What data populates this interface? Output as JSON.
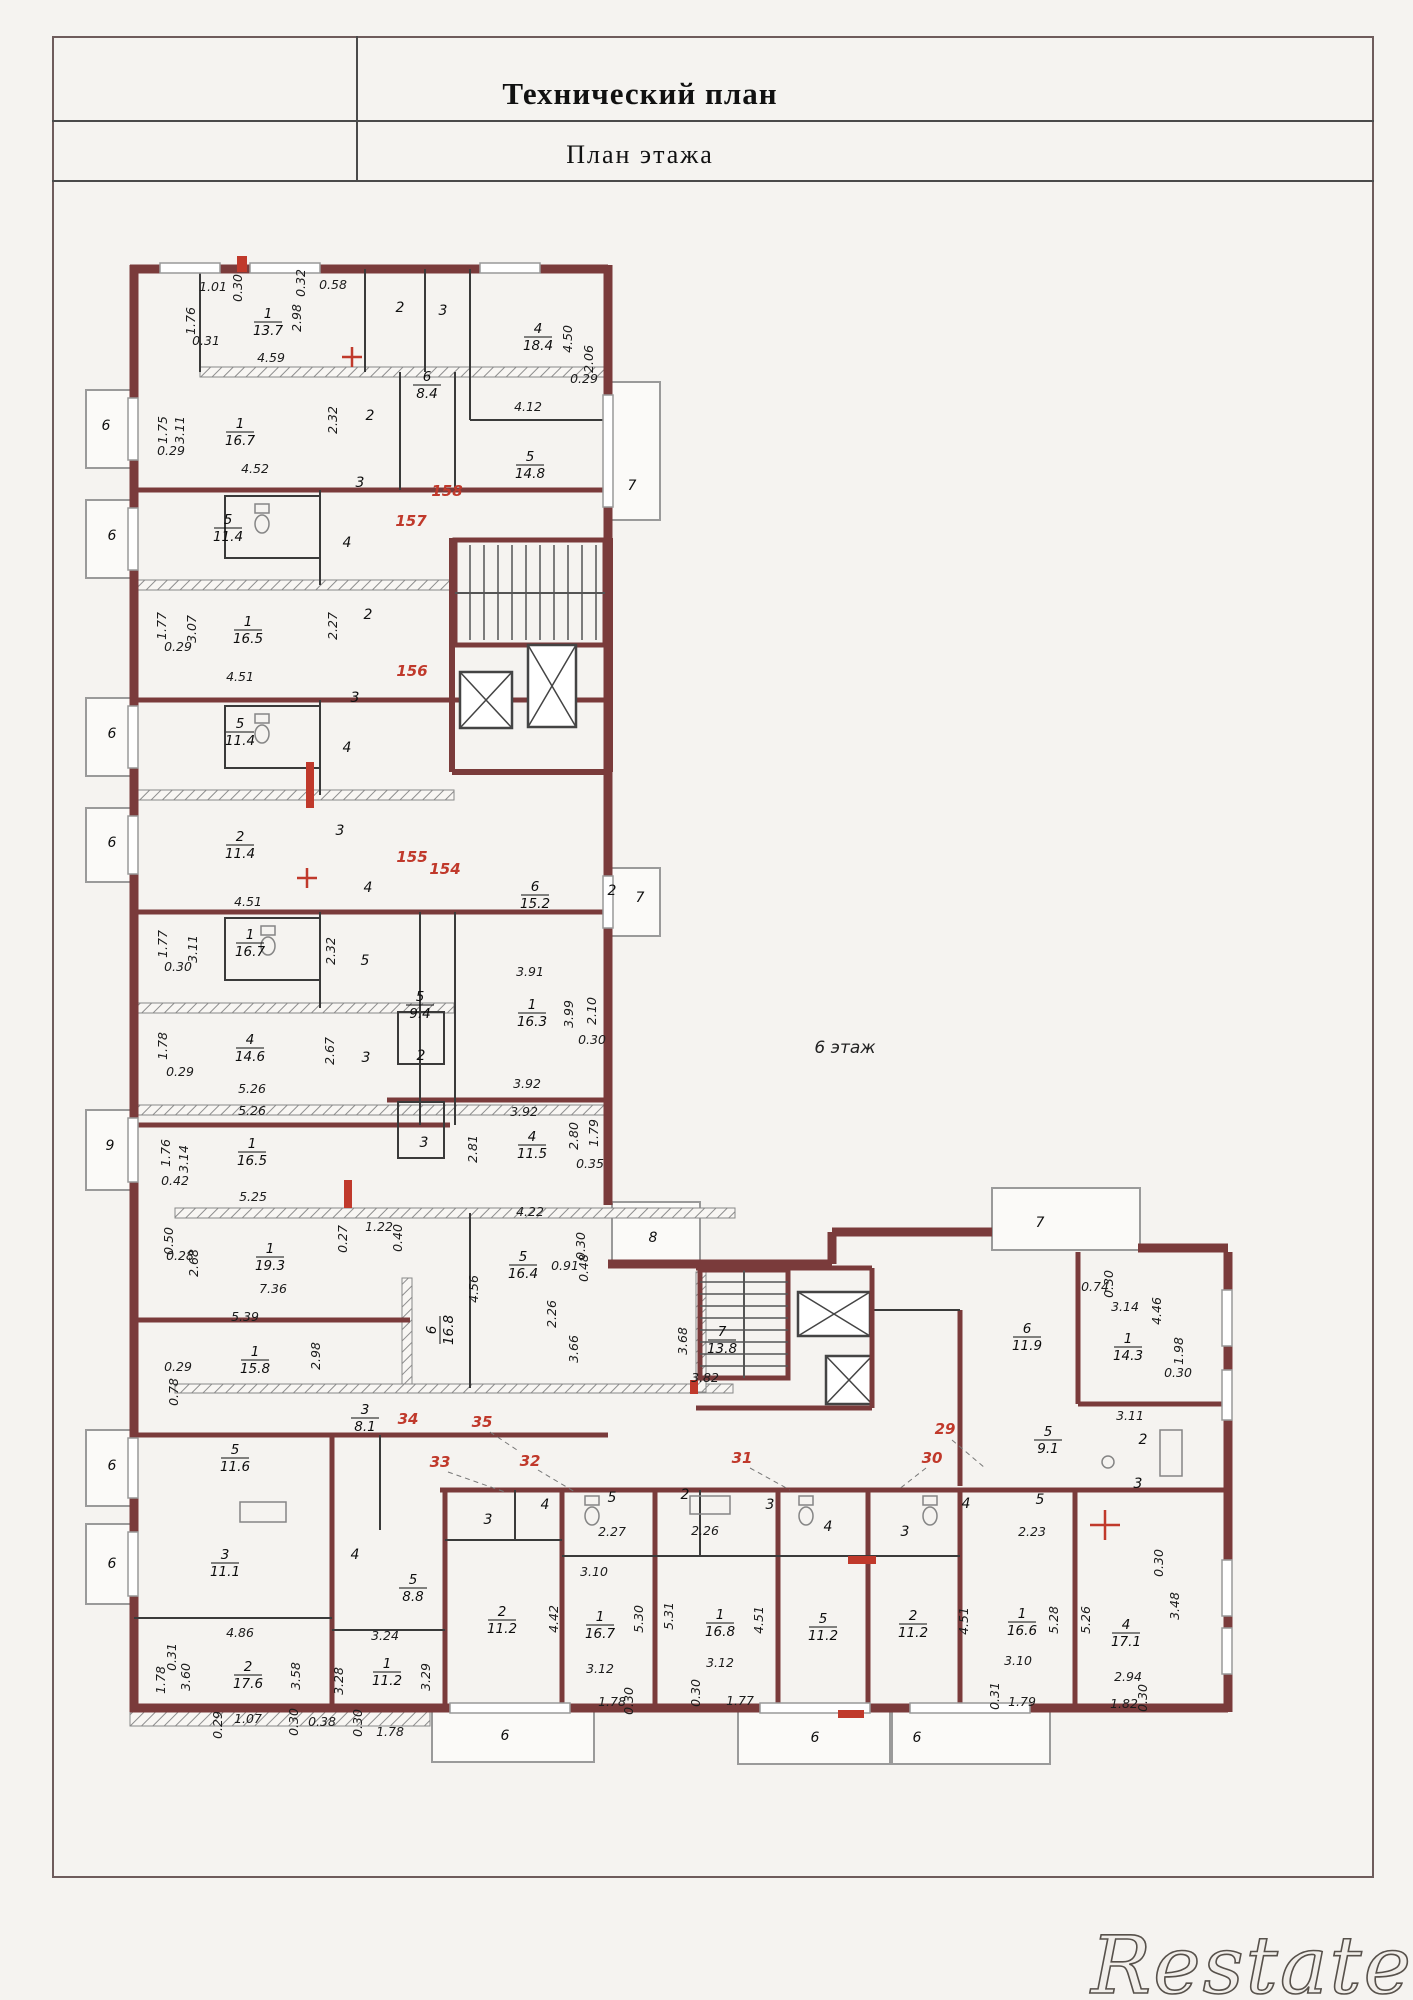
{
  "page": {
    "title": "Технический план",
    "subtitle": "План  этажа",
    "floor_label": "6 этаж",
    "watermark": "Restate"
  },
  "colors": {
    "wall": "#7a3b3b",
    "red_accent": "#c0392b",
    "dim_text": "#1c1c1c",
    "border": "#6e5c5c",
    "paper": "#f5f3f0"
  },
  "plan": {
    "floor_label_pos": {
      "x": 845,
      "y": 1048
    },
    "units": [
      {
        "t": "158",
        "x": 447,
        "y": 496
      },
      {
        "t": "157",
        "x": 411,
        "y": 526
      },
      {
        "t": "156",
        "x": 412,
        "y": 676
      },
      {
        "t": "155",
        "x": 412,
        "y": 862
      },
      {
        "t": "154",
        "x": 445,
        "y": 874
      },
      {
        "t": "35",
        "x": 482,
        "y": 1427
      },
      {
        "t": "34",
        "x": 408,
        "y": 1424
      },
      {
        "t": "33",
        "x": 440,
        "y": 1467
      },
      {
        "t": "32",
        "x": 530,
        "y": 1466
      },
      {
        "t": "31",
        "x": 742,
        "y": 1463
      },
      {
        "t": "30",
        "x": 932,
        "y": 1463
      },
      {
        "t": "29",
        "x": 945,
        "y": 1434
      }
    ],
    "rooms": [
      {
        "n": "1",
        "a": "13.7",
        "x": 268,
        "y": 322
      },
      {
        "n": "1",
        "a": "16.7",
        "x": 240,
        "y": 432
      },
      {
        "n": "4",
        "a": "18.4",
        "x": 538,
        "y": 337
      },
      {
        "n": "6",
        "a": "8.4",
        "x": 427,
        "y": 385
      },
      {
        "n": "5",
        "a": "14.8",
        "x": 530,
        "y": 465
      },
      {
        "n": "5",
        "a": "11.4",
        "x": 228,
        "y": 528
      },
      {
        "n": "1",
        "a": "16.5",
        "x": 248,
        "y": 630
      },
      {
        "n": "5",
        "a": "11.4",
        "x": 240,
        "y": 732
      },
      {
        "n": "2",
        "a": "11.4",
        "x": 240,
        "y": 845
      },
      {
        "n": "1",
        "a": "16.7",
        "x": 250,
        "y": 943
      },
      {
        "n": "5",
        "a": "9.4",
        "x": 420,
        "y": 1005
      },
      {
        "n": "6",
        "a": "15.2",
        "x": 535,
        "y": 895
      },
      {
        "n": "1",
        "a": "16.3",
        "x": 532,
        "y": 1013
      },
      {
        "n": "4",
        "a": "14.6",
        "x": 250,
        "y": 1048
      },
      {
        "n": "4",
        "a": "11.5",
        "x": 532,
        "y": 1145
      },
      {
        "n": "1",
        "a": "16.5",
        "x": 252,
        "y": 1152
      },
      {
        "n": "1",
        "a": "19.3",
        "x": 270,
        "y": 1257
      },
      {
        "n": "1",
        "a": "15.8",
        "x": 255,
        "y": 1360
      },
      {
        "n": "5",
        "a": "16.4",
        "x": 523,
        "y": 1265
      },
      {
        "n": "6",
        "a": "16.8",
        "x": 440,
        "y": 1330,
        "rot": -90
      },
      {
        "n": "7",
        "a": "13.8",
        "x": 722,
        "y": 1340
      },
      {
        "n": "3",
        "a": "8.1",
        "x": 365,
        "y": 1418
      },
      {
        "n": "5",
        "a": "11.6",
        "x": 235,
        "y": 1458
      },
      {
        "n": "6",
        "a": "11.9",
        "x": 1027,
        "y": 1337
      },
      {
        "n": "1",
        "a": "14.3",
        "x": 1128,
        "y": 1347
      },
      {
        "n": "5",
        "a": "9.1",
        "x": 1048,
        "y": 1440
      },
      {
        "n": "3",
        "a": "11.1",
        "x": 225,
        "y": 1563
      },
      {
        "n": "5",
        "a": "8.8",
        "x": 413,
        "y": 1588
      },
      {
        "n": "2",
        "a": "17.6",
        "x": 248,
        "y": 1675
      },
      {
        "n": "1",
        "a": "11.2",
        "x": 387,
        "y": 1672
      },
      {
        "n": "2",
        "a": "11.2",
        "x": 502,
        "y": 1620
      },
      {
        "n": "1",
        "a": "16.7",
        "x": 600,
        "y": 1625
      },
      {
        "n": "1",
        "a": "16.8",
        "x": 720,
        "y": 1623
      },
      {
        "n": "5",
        "a": "11.2",
        "x": 823,
        "y": 1627
      },
      {
        "n": "2",
        "a": "11.2",
        "x": 913,
        "y": 1624
      },
      {
        "n": "1",
        "a": "16.6",
        "x": 1022,
        "y": 1622
      },
      {
        "n": "4",
        "a": "17.1",
        "x": 1126,
        "y": 1633
      }
    ],
    "labels": [
      {
        "t": "2",
        "x": 400,
        "y": 312
      },
      {
        "t": "3",
        "x": 443,
        "y": 315
      },
      {
        "t": "7",
        "x": 632,
        "y": 490
      },
      {
        "t": "6",
        "x": 106,
        "y": 430
      },
      {
        "t": "2",
        "x": 370,
        "y": 420
      },
      {
        "t": "3",
        "x": 360,
        "y": 487
      },
      {
        "t": "6",
        "x": 112,
        "y": 540
      },
      {
        "t": "4",
        "x": 347,
        "y": 547
      },
      {
        "t": "2",
        "x": 368,
        "y": 619
      },
      {
        "t": "3",
        "x": 355,
        "y": 702
      },
      {
        "t": "6",
        "x": 112,
        "y": 738
      },
      {
        "t": "4",
        "x": 347,
        "y": 752
      },
      {
        "t": "3",
        "x": 340,
        "y": 835
      },
      {
        "t": "4",
        "x": 368,
        "y": 892
      },
      {
        "t": "5",
        "x": 365,
        "y": 965
      },
      {
        "t": "6",
        "x": 112,
        "y": 847
      },
      {
        "t": "7",
        "x": 640,
        "y": 902
      },
      {
        "t": "2",
        "x": 612,
        "y": 895
      },
      {
        "t": "2",
        "x": 421,
        "y": 1060
      },
      {
        "t": "3",
        "x": 424,
        "y": 1147
      },
      {
        "t": "3",
        "x": 366,
        "y": 1062
      },
      {
        "t": "9",
        "x": 110,
        "y": 1150
      },
      {
        "t": "8",
        "x": 653,
        "y": 1242
      },
      {
        "t": "7",
        "x": 1040,
        "y": 1227
      },
      {
        "t": "2",
        "x": 1143,
        "y": 1444
      },
      {
        "t": "3",
        "x": 1138,
        "y": 1488
      },
      {
        "t": "5",
        "x": 1040,
        "y": 1504
      },
      {
        "t": "4",
        "x": 966,
        "y": 1508
      },
      {
        "t": "3",
        "x": 770,
        "y": 1509
      },
      {
        "t": "2",
        "x": 685,
        "y": 1499
      },
      {
        "t": "5",
        "x": 612,
        "y": 1502
      },
      {
        "t": "3",
        "x": 488,
        "y": 1524
      },
      {
        "t": "4",
        "x": 545,
        "y": 1509
      },
      {
        "t": "4",
        "x": 828,
        "y": 1531
      },
      {
        "t": "3",
        "x": 905,
        "y": 1536
      },
      {
        "t": "6",
        "x": 112,
        "y": 1470
      },
      {
        "t": "4",
        "x": 355,
        "y": 1559
      },
      {
        "t": "6",
        "x": 112,
        "y": 1568
      },
      {
        "t": "6",
        "x": 505,
        "y": 1740
      },
      {
        "t": "6",
        "x": 815,
        "y": 1742
      },
      {
        "t": "6",
        "x": 917,
        "y": 1742
      }
    ],
    "dims": [
      {
        "t": "1.01",
        "x": 213,
        "y": 291
      },
      {
        "t": "0.30",
        "x": 242,
        "y": 288,
        "r": 1
      },
      {
        "t": "0.32",
        "x": 305,
        "y": 283,
        "r": 1
      },
      {
        "t": "2.98",
        "x": 301,
        "y": 318,
        "r": 1
      },
      {
        "t": "0.58",
        "x": 333,
        "y": 289
      },
      {
        "t": "1.76",
        "x": 195,
        "y": 321,
        "r": 1
      },
      {
        "t": "0.31",
        "x": 206,
        "y": 345
      },
      {
        "t": "4.59",
        "x": 271,
        "y": 362
      },
      {
        "t": "2.32",
        "x": 337,
        "y": 420,
        "r": 1
      },
      {
        "t": "4.50",
        "x": 572,
        "y": 339,
        "r": 1
      },
      {
        "t": "2.06",
        "x": 593,
        "y": 359,
        "r": 1
      },
      {
        "t": "0.29",
        "x": 584,
        "y": 383
      },
      {
        "t": "4.12",
        "x": 528,
        "y": 411
      },
      {
        "t": "1.75",
        "x": 167,
        "y": 430,
        "r": 1
      },
      {
        "t": "3.11",
        "x": 184,
        "y": 430,
        "r": 1
      },
      {
        "t": "0.29",
        "x": 171,
        "y": 455
      },
      {
        "t": "4.52",
        "x": 255,
        "y": 473
      },
      {
        "t": "1.77",
        "x": 166,
        "y": 626,
        "r": 1
      },
      {
        "t": "3.07",
        "x": 196,
        "y": 629,
        "r": 1
      },
      {
        "t": "0.29",
        "x": 178,
        "y": 651
      },
      {
        "t": "4.51",
        "x": 240,
        "y": 681
      },
      {
        "t": "2.27",
        "x": 337,
        "y": 626,
        "r": 1
      },
      {
        "t": "4.51",
        "x": 248,
        "y": 906
      },
      {
        "t": "1.77",
        "x": 167,
        "y": 944,
        "r": 1
      },
      {
        "t": "3.11",
        "x": 197,
        "y": 949,
        "r": 1
      },
      {
        "t": "0.30",
        "x": 178,
        "y": 971
      },
      {
        "t": "2.32",
        "x": 335,
        "y": 951,
        "r": 1
      },
      {
        "t": "3.91",
        "x": 530,
        "y": 976
      },
      {
        "t": "3.99",
        "x": 573,
        "y": 1014,
        "r": 1
      },
      {
        "t": "2.10",
        "x": 596,
        "y": 1011,
        "r": 1
      },
      {
        "t": "0.30",
        "x": 592,
        "y": 1044
      },
      {
        "t": "2.67",
        "x": 334,
        "y": 1051,
        "r": 1
      },
      {
        "t": "1.78",
        "x": 167,
        "y": 1046,
        "r": 1
      },
      {
        "t": "0.29",
        "x": 180,
        "y": 1076
      },
      {
        "t": "5.26",
        "x": 252,
        "y": 1093
      },
      {
        "t": "5.26",
        "x": 252,
        "y": 1115
      },
      {
        "t": "3.92",
        "x": 527,
        "y": 1088
      },
      {
        "t": "3.92",
        "x": 524,
        "y": 1116
      },
      {
        "t": "2.81",
        "x": 477,
        "y": 1149,
        "r": 1
      },
      {
        "t": "2.80",
        "x": 578,
        "y": 1136,
        "r": 1
      },
      {
        "t": "1.79",
        "x": 598,
        "y": 1133,
        "r": 1
      },
      {
        "t": "0.35",
        "x": 590,
        "y": 1168
      },
      {
        "t": "1.76",
        "x": 170,
        "y": 1153,
        "r": 1
      },
      {
        "t": "3.14",
        "x": 188,
        "y": 1159,
        "r": 1
      },
      {
        "t": "0.42",
        "x": 175,
        "y": 1185
      },
      {
        "t": "5.25",
        "x": 253,
        "y": 1201
      },
      {
        "t": "0.50",
        "x": 173,
        "y": 1241,
        "r": 1
      },
      {
        "t": "0.28",
        "x": 180,
        "y": 1260
      },
      {
        "t": "2.68",
        "x": 198,
        "y": 1263,
        "r": 1
      },
      {
        "t": "7.36",
        "x": 273,
        "y": 1293
      },
      {
        "t": "0.27",
        "x": 347,
        "y": 1239,
        "r": 1
      },
      {
        "t": "1.22",
        "x": 379,
        "y": 1231
      },
      {
        "t": "0.40",
        "x": 402,
        "y": 1238,
        "r": 1
      },
      {
        "t": "5.39",
        "x": 245,
        "y": 1321
      },
      {
        "t": "2.98",
        "x": 320,
        "y": 1356,
        "r": 1
      },
      {
        "t": "0.29",
        "x": 178,
        "y": 1371
      },
      {
        "t": "0.78",
        "x": 178,
        "y": 1392,
        "r": 1
      },
      {
        "t": "4.22",
        "x": 530,
        "y": 1216
      },
      {
        "t": "4.56",
        "x": 478,
        "y": 1289,
        "r": 1
      },
      {
        "t": "0.91",
        "x": 565,
        "y": 1270
      },
      {
        "t": "0.30",
        "x": 585,
        "y": 1246,
        "r": 1
      },
      {
        "t": "0.48",
        "x": 588,
        "y": 1268,
        "r": 1
      },
      {
        "t": "2.26",
        "x": 556,
        "y": 1314,
        "r": 1
      },
      {
        "t": "3.66",
        "x": 578,
        "y": 1349,
        "r": 1
      },
      {
        "t": "3.68",
        "x": 687,
        "y": 1341,
        "r": 1
      },
      {
        "t": "3.82",
        "x": 705,
        "y": 1382
      },
      {
        "t": "0.74",
        "x": 1095,
        "y": 1291
      },
      {
        "t": "0.30",
        "x": 1113,
        "y": 1284,
        "r": 1
      },
      {
        "t": "3.14",
        "x": 1125,
        "y": 1311
      },
      {
        "t": "4.46",
        "x": 1161,
        "y": 1311,
        "r": 1
      },
      {
        "t": "1.98",
        "x": 1183,
        "y": 1351,
        "r": 1
      },
      {
        "t": "0.30",
        "x": 1178,
        "y": 1377
      },
      {
        "t": "3.11",
        "x": 1130,
        "y": 1420
      },
      {
        "t": "2.23",
        "x": 1032,
        "y": 1536
      },
      {
        "t": "2.26",
        "x": 705,
        "y": 1535
      },
      {
        "t": "2.27",
        "x": 612,
        "y": 1536
      },
      {
        "t": "4.86",
        "x": 240,
        "y": 1637
      },
      {
        "t": "0.31",
        "x": 176,
        "y": 1657,
        "r": 1
      },
      {
        "t": "1.78",
        "x": 165,
        "y": 1680,
        "r": 1
      },
      {
        "t": "3.60",
        "x": 190,
        "y": 1677,
        "r": 1
      },
      {
        "t": "3.58",
        "x": 300,
        "y": 1676,
        "r": 1
      },
      {
        "t": "0.29",
        "x": 222,
        "y": 1725,
        "r": 1
      },
      {
        "t": "1.07",
        "x": 248,
        "y": 1723
      },
      {
        "t": "0.30",
        "x": 298,
        "y": 1722,
        "r": 1
      },
      {
        "t": "0.38",
        "x": 322,
        "y": 1726
      },
      {
        "t": "0.30",
        "x": 362,
        "y": 1723,
        "r": 1
      },
      {
        "t": "1.78",
        "x": 390,
        "y": 1736
      },
      {
        "t": "3.24",
        "x": 385,
        "y": 1640
      },
      {
        "t": "3.28",
        "x": 343,
        "y": 1681,
        "r": 1
      },
      {
        "t": "3.29",
        "x": 430,
        "y": 1677,
        "r": 1
      },
      {
        "t": "3.10",
        "x": 594,
        "y": 1576
      },
      {
        "t": "4.42",
        "x": 558,
        "y": 1619,
        "r": 1
      },
      {
        "t": "5.30",
        "x": 643,
        "y": 1619,
        "r": 1
      },
      {
        "t": "5.31",
        "x": 673,
        "y": 1616,
        "r": 1
      },
      {
        "t": "3.12",
        "x": 600,
        "y": 1673
      },
      {
        "t": "1.78",
        "x": 612,
        "y": 1706
      },
      {
        "t": "0.30",
        "x": 633,
        "y": 1701,
        "r": 1
      },
      {
        "t": "3.12",
        "x": 720,
        "y": 1667
      },
      {
        "t": "0.30",
        "x": 700,
        "y": 1693,
        "r": 1
      },
      {
        "t": "1.77",
        "x": 740,
        "y": 1705
      },
      {
        "t": "4.51",
        "x": 763,
        "y": 1620,
        "r": 1
      },
      {
        "t": "4.51",
        "x": 968,
        "y": 1621,
        "r": 1
      },
      {
        "t": "3.10",
        "x": 1018,
        "y": 1665
      },
      {
        "t": "5.28",
        "x": 1058,
        "y": 1620,
        "r": 1
      },
      {
        "t": "5.26",
        "x": 1090,
        "y": 1620,
        "r": 1
      },
      {
        "t": "0.31",
        "x": 999,
        "y": 1696,
        "r": 1
      },
      {
        "t": "1.79",
        "x": 1022,
        "y": 1706
      },
      {
        "t": "3.48",
        "x": 1179,
        "y": 1606,
        "r": 1
      },
      {
        "t": "0.30",
        "x": 1163,
        "y": 1563,
        "r": 1
      },
      {
        "t": "2.94",
        "x": 1128,
        "y": 1681
      },
      {
        "t": "1.82",
        "x": 1124,
        "y": 1708
      },
      {
        "t": "0.30",
        "x": 1147,
        "y": 1698,
        "r": 1
      }
    ]
  }
}
